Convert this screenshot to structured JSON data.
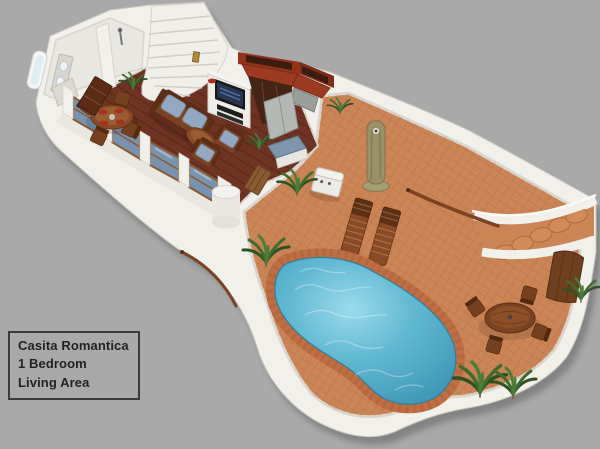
{
  "label_box": {
    "lines": [
      "Casita Romantica",
      "1 Bedroom",
      "Living Area"
    ]
  },
  "figure": {
    "type": "3d-floor-plan-rendering",
    "features": [
      "bathroom",
      "staircase",
      "dining-table",
      "living-room-sofa",
      "tv-wall",
      "kitchen",
      "window-wall",
      "bbq-grill",
      "bar-counter",
      "wall-fountain",
      "sun-loungers",
      "kidney-pool",
      "outdoor-dining-set",
      "terrace-door",
      "outdoor-steps",
      "palm-plants"
    ]
  },
  "palette": {
    "background": "#a9a9a9",
    "wall": "#f2f0ea",
    "wall-shade": "#dbd7cf",
    "interior-floor": "#6e3323",
    "terrace": "#cb8455",
    "pool-coping": "#c06f45",
    "pool-water": "#4aa4c1",
    "pool-water-light": "#96d9e7",
    "wood": "#7c4322",
    "cushion": "#93a9c2",
    "kitchen-brick": "#93331c",
    "glass": "#7793b0",
    "plant": "#3f6b2e",
    "stone": "#9a9166",
    "tv": "#161616",
    "red-accent": "#a83022",
    "label-text": "#222222",
    "label-border": "#3a3a3a"
  }
}
